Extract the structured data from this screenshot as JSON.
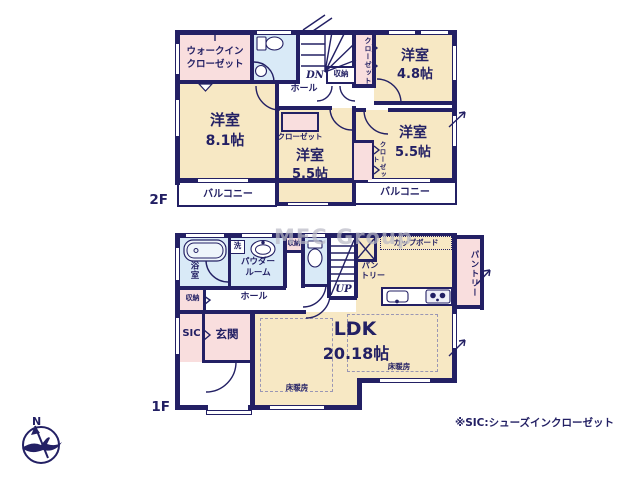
{
  "floor2": {
    "label": "2F",
    "walk_in_closet_line1": "ウォークイン",
    "walk_in_closet_line2": "クローゼット",
    "room_nw_name": "洋室",
    "room_nw_size": "8.1帖",
    "room_ne_name": "洋室",
    "room_ne_size": "4.8帖",
    "room_center_name": "洋室",
    "room_center_size": "5.5帖",
    "room_se_name": "洋室",
    "room_se_size": "5.5帖",
    "closet_center": "クローゼット",
    "closet_ne_vert": "クローゼット",
    "closet_se_vert": "クローゼット",
    "storage": "収納",
    "hall": "ホール",
    "stairs_down": "DN",
    "balcony_west": "バルコニー",
    "balcony_east": "バルコニー"
  },
  "floor1": {
    "label": "1F",
    "bathroom_vert": "浴室",
    "laundry": "洗",
    "powder_line1": "パウダー",
    "powder_line2": "ルーム",
    "storage_north": "収納",
    "storage_west": "収納",
    "hall": "ホール",
    "stairs_up": "UP",
    "sic": "SIC",
    "entrance": "玄関",
    "pantry_north_line1": "パン",
    "pantry_north_line2": "トリー",
    "cupboard": "カップボード",
    "pantry_east_vert": "パントリー",
    "ldk_name": "LDK",
    "ldk_size": "20.18帖",
    "floor_heating_a": "床暖房",
    "floor_heating_b": "床暖房"
  },
  "compass": {
    "north": "N"
  },
  "watermark": "MEC Group",
  "footnote": "※SIC:シューズインクローゼット",
  "colors": {
    "wall": "#232064",
    "room": "#f7e8c4",
    "closet": "#f9dede",
    "water": "#d9eaf7",
    "text": "#232064",
    "watermark": "#b9b9c6"
  }
}
